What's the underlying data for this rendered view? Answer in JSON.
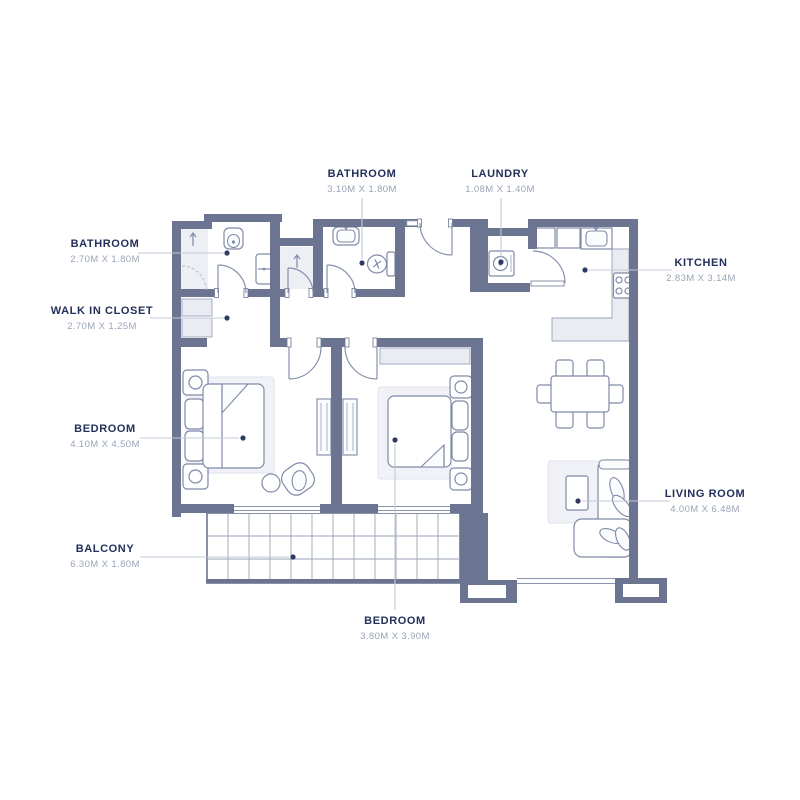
{
  "floorplan": {
    "labels": [
      {
        "id": "bathroom-1",
        "name": "BATHROOM",
        "dims": "2.70M X 1.80M"
      },
      {
        "id": "walk-in-closet",
        "name": "WALK IN CLOSET",
        "dims": "2.70M X 1.25M"
      },
      {
        "id": "bedroom-1",
        "name": "BEDROOM",
        "dims": "4.10M X 4.50M"
      },
      {
        "id": "balcony",
        "name": "BALCONY",
        "dims": "6.30M X 1.80M"
      },
      {
        "id": "bathroom-2",
        "name": "BATHROOM",
        "dims": "3.10M X 1.80M"
      },
      {
        "id": "laundry",
        "name": "LAUNDRY",
        "dims": "1.08M X 1.40M"
      },
      {
        "id": "kitchen",
        "name": "KITCHEN",
        "dims": "2.83M X 3.14M"
      },
      {
        "id": "living-room",
        "name": "LIVING ROOM",
        "dims": "4.00M X 6.48M"
      },
      {
        "id": "bedroom-2",
        "name": "BEDROOM",
        "dims": "3.80M X 3.90M"
      }
    ],
    "colors": {
      "wall": "#6b7591",
      "label_text": "#233059",
      "dimension_text": "#9aa3b7",
      "leader_line": "#c3c9d6",
      "furniture_stroke": "#7e8aa7",
      "furniture_fill": "#e9ecf2",
      "background": "#ffffff"
    }
  }
}
